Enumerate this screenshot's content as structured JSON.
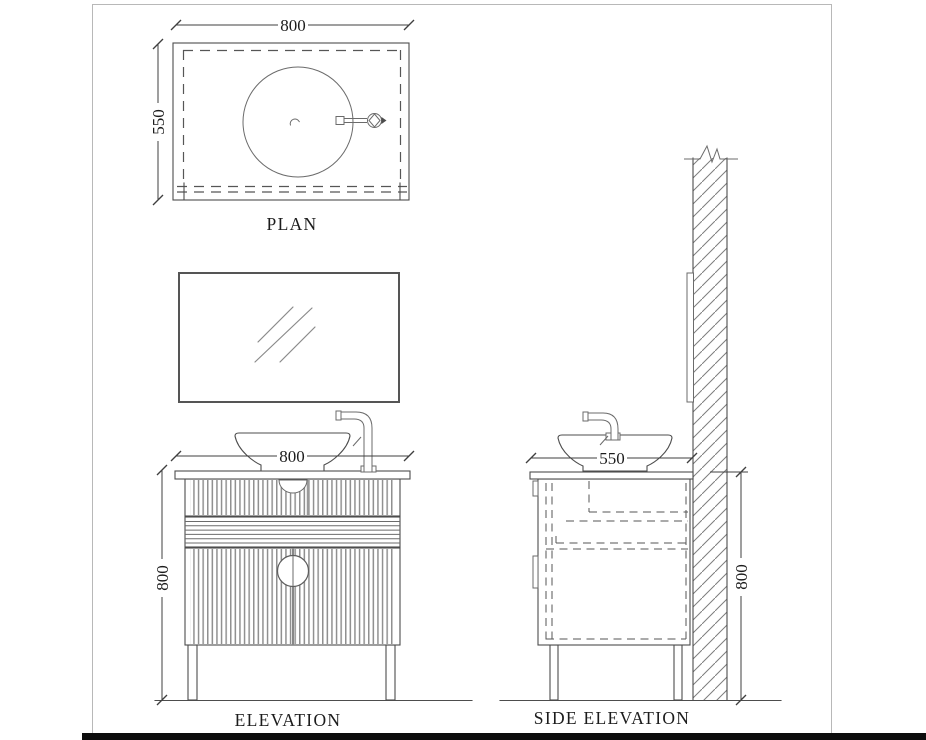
{
  "drawing": {
    "titles": {
      "plan": "PLAN",
      "elevation": "ELEVATION",
      "side_elevation": "SIDE ELEVATION"
    },
    "dims": {
      "plan_width": "800",
      "plan_depth": "550",
      "elev_width": "800",
      "elev_height": "800",
      "side_depth": "550",
      "side_height": "800"
    },
    "colors": {
      "line": "#4d4d4d",
      "hidden_line": "#565656",
      "hatch": "#7d7d7d",
      "flute": "#909090",
      "text": "#1c1c1c",
      "page_border": "#b8b8b8",
      "bottom_bar": "#0d0d0d",
      "background": "#ffffff"
    }
  }
}
